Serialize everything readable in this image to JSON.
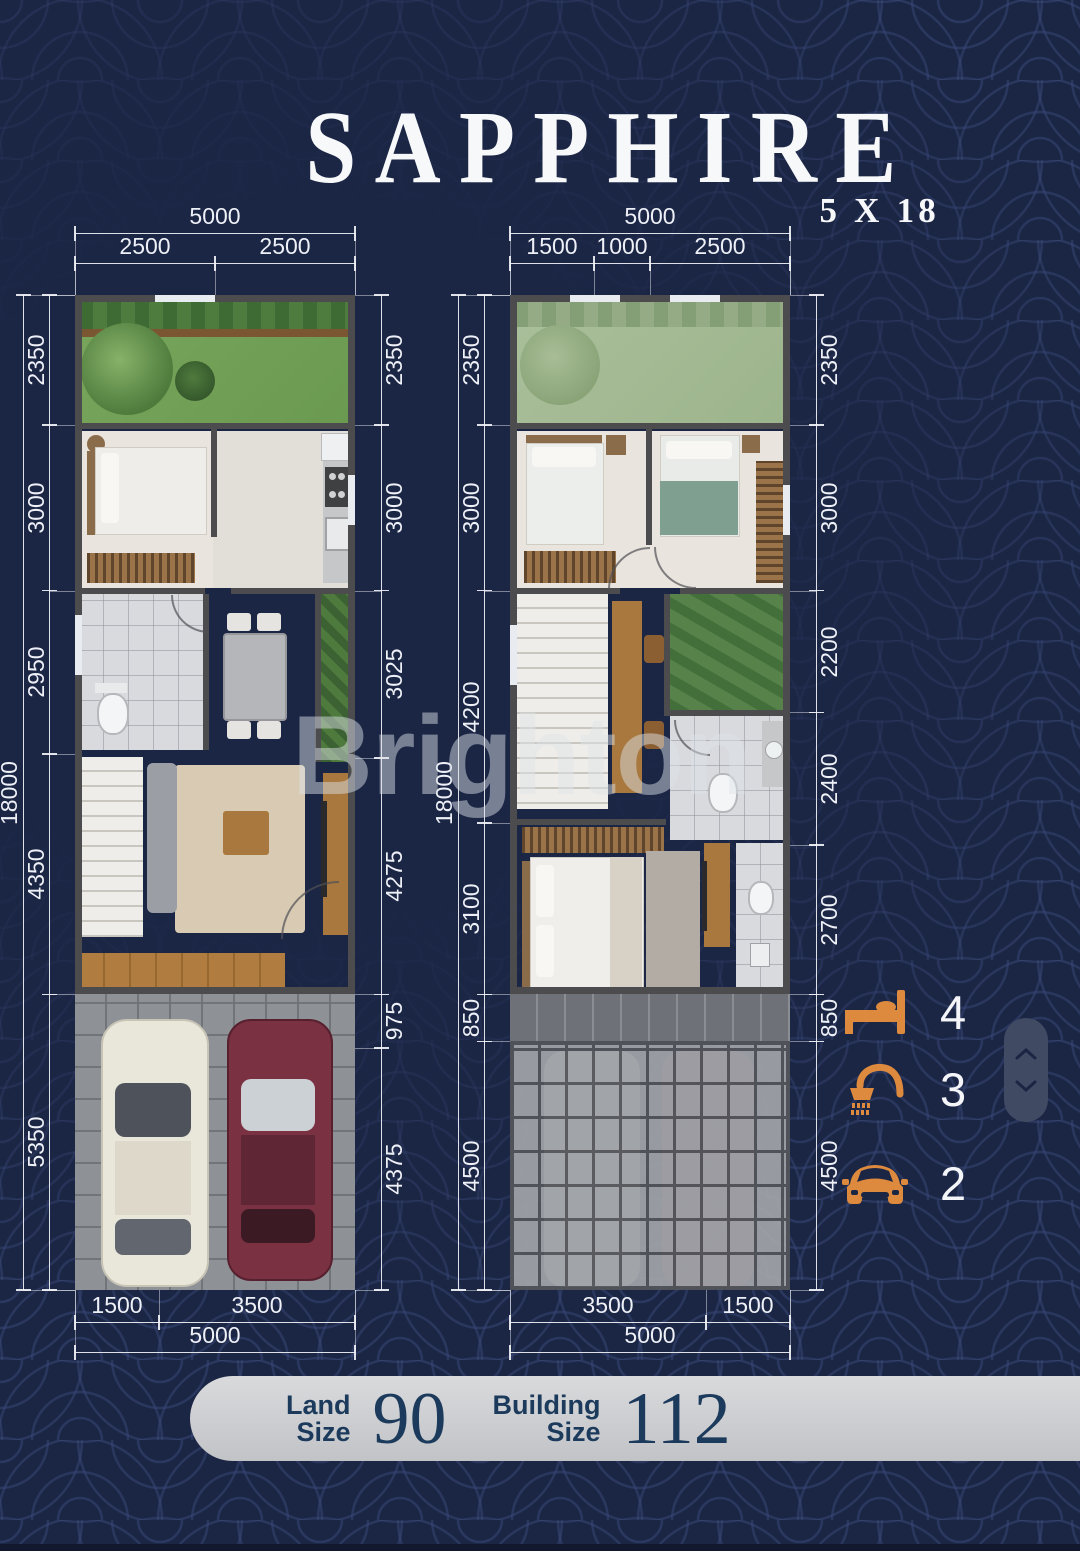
{
  "title": {
    "name": "SAPPHIRE",
    "size": "5 X 18"
  },
  "watermark": "Brighton",
  "dims": {
    "plan1": {
      "top": {
        "overall": 5000,
        "segments": [
          2500,
          2500
        ]
      },
      "bottom": {
        "overall": 5000,
        "segments": [
          1500,
          3500
        ]
      },
      "left": {
        "overall": 18000,
        "segments": [
          2350,
          3000,
          2950,
          4350,
          5350
        ]
      },
      "right": {
        "segments": [
          2350,
          3000,
          3025,
          4275,
          975,
          4375
        ]
      }
    },
    "plan2": {
      "top": {
        "overall": 5000,
        "segments": [
          1500,
          1000,
          2500
        ]
      },
      "bottom": {
        "overall": 5000,
        "segments": [
          3500,
          1500
        ]
      },
      "left": {
        "overall": 18000,
        "segments": [
          2350,
          3000,
          4200,
          3100,
          850,
          4500
        ]
      },
      "right": {
        "segments": [
          2350,
          3000,
          2200,
          2400,
          2700,
          850,
          4500
        ]
      }
    }
  },
  "features": [
    {
      "name": "bedrooms",
      "icon": "bed-icon",
      "count": "4"
    },
    {
      "name": "bathrooms",
      "icon": "shower-icon",
      "count": "3"
    },
    {
      "name": "carports",
      "icon": "car-icon",
      "count": "2"
    }
  ],
  "summary": {
    "land_label_line1": "Land",
    "land_label_line2": "Size",
    "land_value": "90",
    "building_label_line1": "Building",
    "building_label_line2": "Size",
    "building_value": "112"
  },
  "colors": {
    "background": "#1b2544",
    "pattern_stroke": "#3a4a78",
    "accent_orange": "#dd8a3e",
    "dimension_text": "#edf0f6",
    "bar_background": "#cdced2",
    "bar_text": "#1c3a5c"
  }
}
